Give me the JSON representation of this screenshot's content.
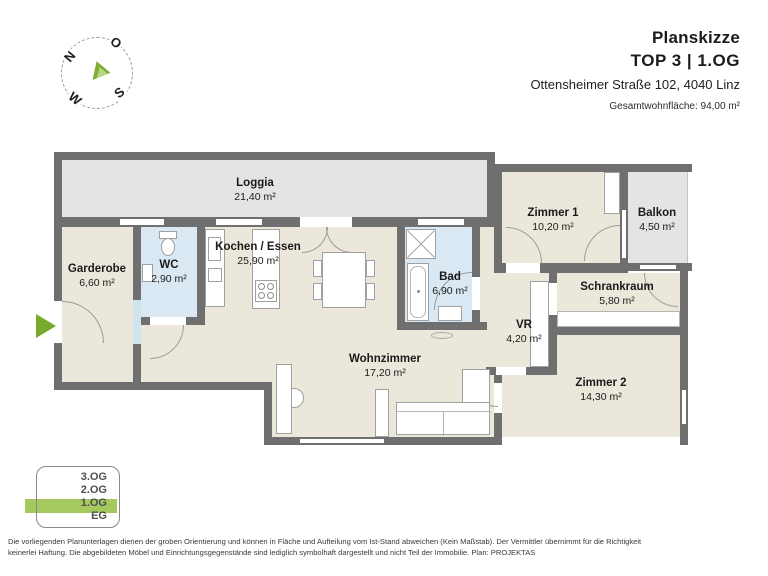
{
  "header": {
    "title": "Planskizze",
    "subtitle": "TOP 3  |  1.OG",
    "address": "Ottensheimer Straße 102, 4040 Linz",
    "total_area": "Gesamtwohnfläche: 94,00 m²"
  },
  "compass": {
    "north": "N",
    "east": "O",
    "south": "S",
    "west": "W"
  },
  "plan": {
    "rooms": [
      {
        "name": "Loggia",
        "area": "21,40 m²"
      },
      {
        "name": "Garderobe",
        "area": "6,60 m²"
      },
      {
        "name": "WC",
        "area": "2,90 m²"
      },
      {
        "name": "Kochen / Essen",
        "area": "25,90 m²"
      },
      {
        "name": "Bad",
        "area": "6,90 m²"
      },
      {
        "name": "Zimmer 1",
        "area": "10,20 m²"
      },
      {
        "name": "Balkon",
        "area": "4,50 m²"
      },
      {
        "name": "Schrankraum",
        "area": "5,80 m²"
      },
      {
        "name": "VR",
        "area": "4,20 m²"
      },
      {
        "name": "Wohnzimmer",
        "area": "17,20 m²"
      },
      {
        "name": "Zimmer 2",
        "area": "14,30 m²"
      }
    ]
  },
  "floor_selector": {
    "floors": [
      {
        "label": "3.OG",
        "active": false
      },
      {
        "label": "2.OG",
        "active": false
      },
      {
        "label": "1.OG",
        "active": true
      },
      {
        "label": "EG",
        "active": false
      }
    ],
    "active_label": "1.OG"
  },
  "footer": {
    "line1": "Die vorliegenden Planunterlagen dienen der groben Orientierung und können in Fläche und Aufteilung vom Ist-Stand abweichen (Kein Maßstab). Der Vermittler übernimmt für die Richtigkeit",
    "line2": "keinerlei Haftung. Die abgebildeten Möbel und Einrichtungsgegenstände sind lediglich symbolhaft dargestellt und nicht Teil der Immobilie. Plan: PROJEKTAS"
  },
  "colors": {
    "wall": "#6f6f6f",
    "room_beige": "#ece7db",
    "outdoor_gray": "#e5e4e2",
    "wet_room_blue": "#d9e8f3",
    "accent_green": "#76a92c",
    "floor_highlight_green": "#a5c95e"
  }
}
